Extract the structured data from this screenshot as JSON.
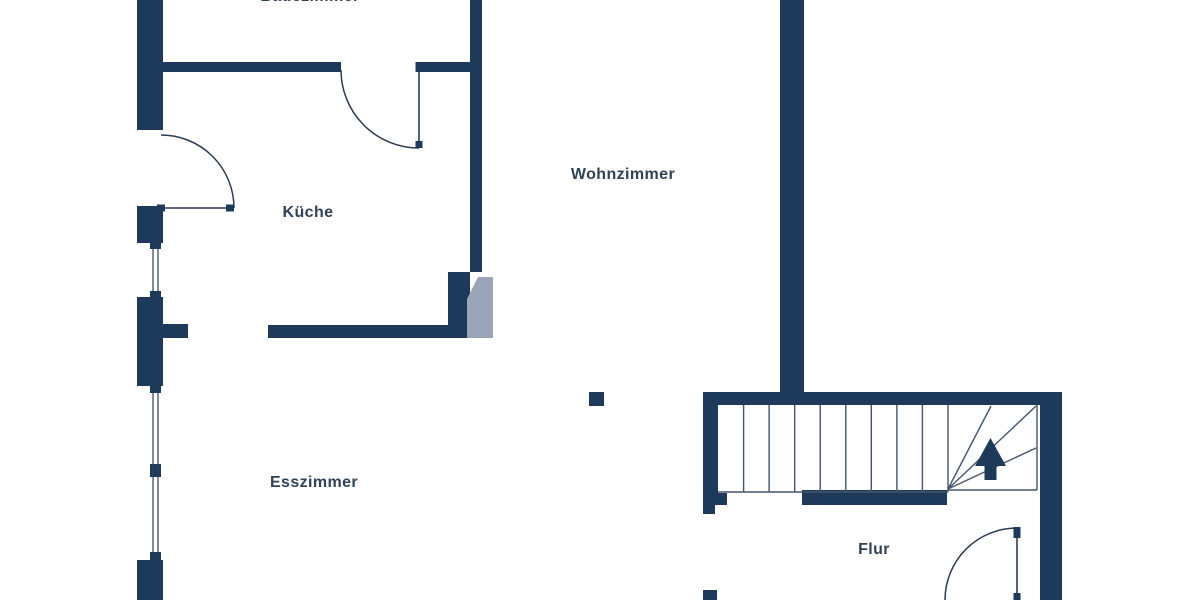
{
  "plan": {
    "kind": "apartment-floor-plan",
    "language": "de"
  },
  "rooms": {
    "badezimmer": {
      "label": "Badezimmer"
    },
    "kueche": {
      "label": "Küche"
    },
    "wohnzimmer": {
      "label": "Wohnzimmer"
    },
    "esszimmer": {
      "label": "Esszimmer"
    },
    "flur": {
      "label": "Flur"
    }
  },
  "stairs": {
    "direction_icon": "arrow-up-icon",
    "straight_treads": 9,
    "winder_treads": 4
  },
  "features": {
    "doors": [
      "kueche-door",
      "badezimmer-door",
      "flur-door"
    ],
    "windows": [
      "esszimmer-window-upper",
      "esszimmer-window-lower"
    ]
  },
  "colors": {
    "wall": "#1e3a5b",
    "chamfer_gray": "#9aa5b9",
    "thin_line": "#2b3c52",
    "tread_line": "#44556d",
    "label_text": "#2f4257",
    "background": "#ffffff"
  }
}
